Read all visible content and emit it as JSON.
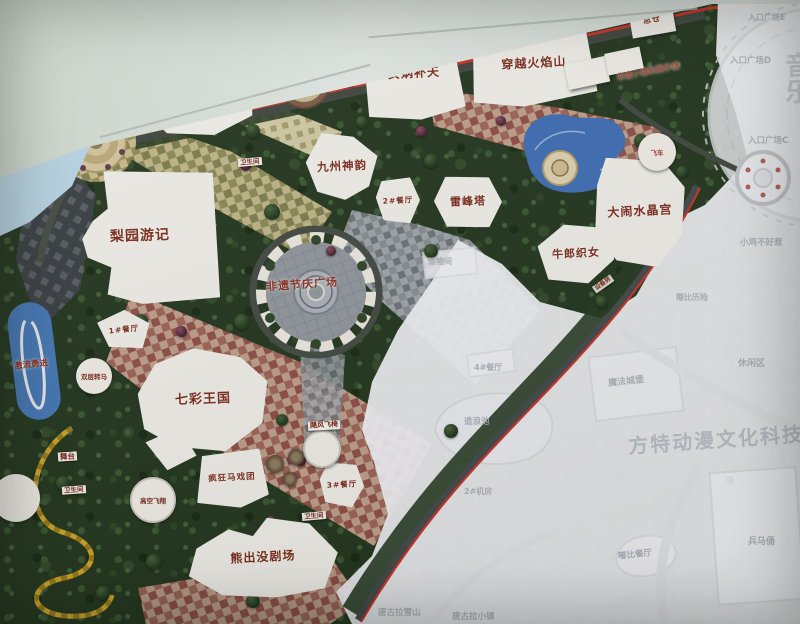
{
  "map": {
    "labels": {
      "qiangu_dielian": "千古蝶恋",
      "nuwa_butian": "女娲补天",
      "chuanyue_huoyanshan": "穿越火焰山",
      "zongcang": "总仓",
      "jiuzhou_shenyun": "九州神韵",
      "leifengta": "雷峰塔",
      "danao_shuijinggong": "大闹水晶宫",
      "niulang_zhinu": "牛郎织女",
      "liyuan_youji": "梨园游记",
      "qicai_wangguo": "七彩王国",
      "xiongchumo_juchang": "熊出没剧场",
      "fengkuang_maxituan": "疯狂马戏团",
      "feiyi_jieqing_guangchang": "非遗节庆广场",
      "feiyi_xiaozhen": "非遗小镇和展示馆",
      "jiliu_yongjin": "激流勇进",
      "shuangceng_zhuanma": "双层转马",
      "gaokong_feixiang": "高空飞翔",
      "jufeng_feiyi": "飓风飞椅",
      "feiche": "飞车",
      "wutai": "舞台",
      "canting1": "1#餐厅",
      "canting2": "2#餐厅",
      "canting3": "3#餐厅",
      "weishengjian": "卫生间",
      "zhilengjifang": "2#制冷机房",
      "bianpeidian": "1#变配电",
      "shebeifang": "设备房"
    },
    "faded": {
      "chuwujian": "储物间",
      "canting4": "4#餐厅",
      "zaolangchi": "造浪池",
      "jifang2": "2#机房",
      "mofa_chengbao": "魔法城堡",
      "xiuxianqu": "休闲区",
      "xiaoji_buhaore": "小鸡不好惹",
      "dubi_lixian": "嘟比历险",
      "dubi_canting": "嘟比餐厅",
      "bingmayong": "兵马俑",
      "tanggula_xueshan": "唐古拉雪山",
      "tanggula_xiaozhen": "唐古拉小镇",
      "entrance_e": "入口广场E",
      "entrance_d": "入口广场D",
      "entrance_c": "入口广场C",
      "park_watermark": "方特动漫文化科技",
      "yin_watermark": "音乐"
    },
    "colors": {
      "label_red": "#7b2d1d",
      "boundary_red": "#c5332b",
      "water_blue": "#3e6db2",
      "path_tan": "#c6b98b",
      "faded_text": "#a6abb4",
      "vegetation": "#24371f"
    }
  }
}
